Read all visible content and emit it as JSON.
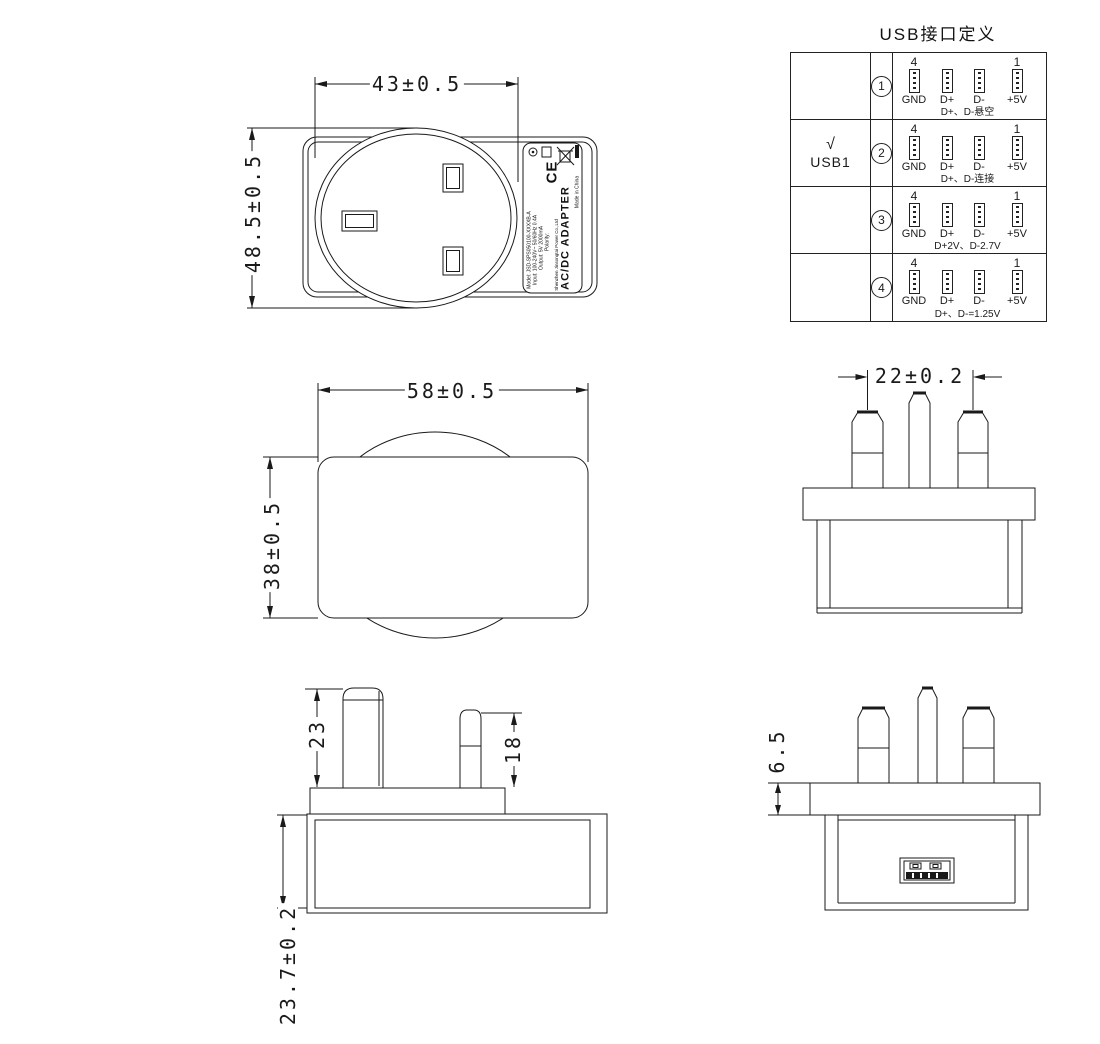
{
  "usb_table": {
    "title": "USB接口定义",
    "pin_first_num": "4",
    "pin_last_num": "1",
    "pin_labels": [
      "GND",
      "D+",
      "D-",
      "+5V"
    ],
    "check_mark": "√",
    "check_label": "USB1",
    "rows": [
      {
        "num": "1",
        "note": "D+、D-悬空"
      },
      {
        "num": "2",
        "note": "D+、D-连接"
      },
      {
        "num": "3",
        "note": "D+2V、D-2.7V"
      },
      {
        "num": "4",
        "note": "D+、D-=1.25V"
      }
    ]
  },
  "dimensions": {
    "face_width": "43±0.5",
    "face_height": "48.5±0.5",
    "body_width": "58±0.5",
    "body_height": "38±0.5",
    "pin_spacing": "22±0.2",
    "earth_pin_length": "23",
    "power_pin_length": "18",
    "body_depth": "23.7±0.2",
    "flange_thickness": "6.5"
  },
  "label": {
    "product": "AC/DC ADAPTER",
    "model": "Model: JSD-SPS050100-XXXXB-A",
    "input": "Input: 100-240V~ 50/60Hz 0.4A",
    "output": "Output: 5V 2000mA",
    "polarity": "Polarity:",
    "maker": "Shenzhen Jinsongtai Power Co.,Ltd",
    "origin": "Made in China",
    "ce_mark": "CE",
    "icons": [
      "certification-circle-icon",
      "box-icon",
      "weee-crossed-bin-icon",
      "black-bar-icon"
    ]
  },
  "colors": {
    "line": "#1a1a1a",
    "background": "#ffffff"
  }
}
